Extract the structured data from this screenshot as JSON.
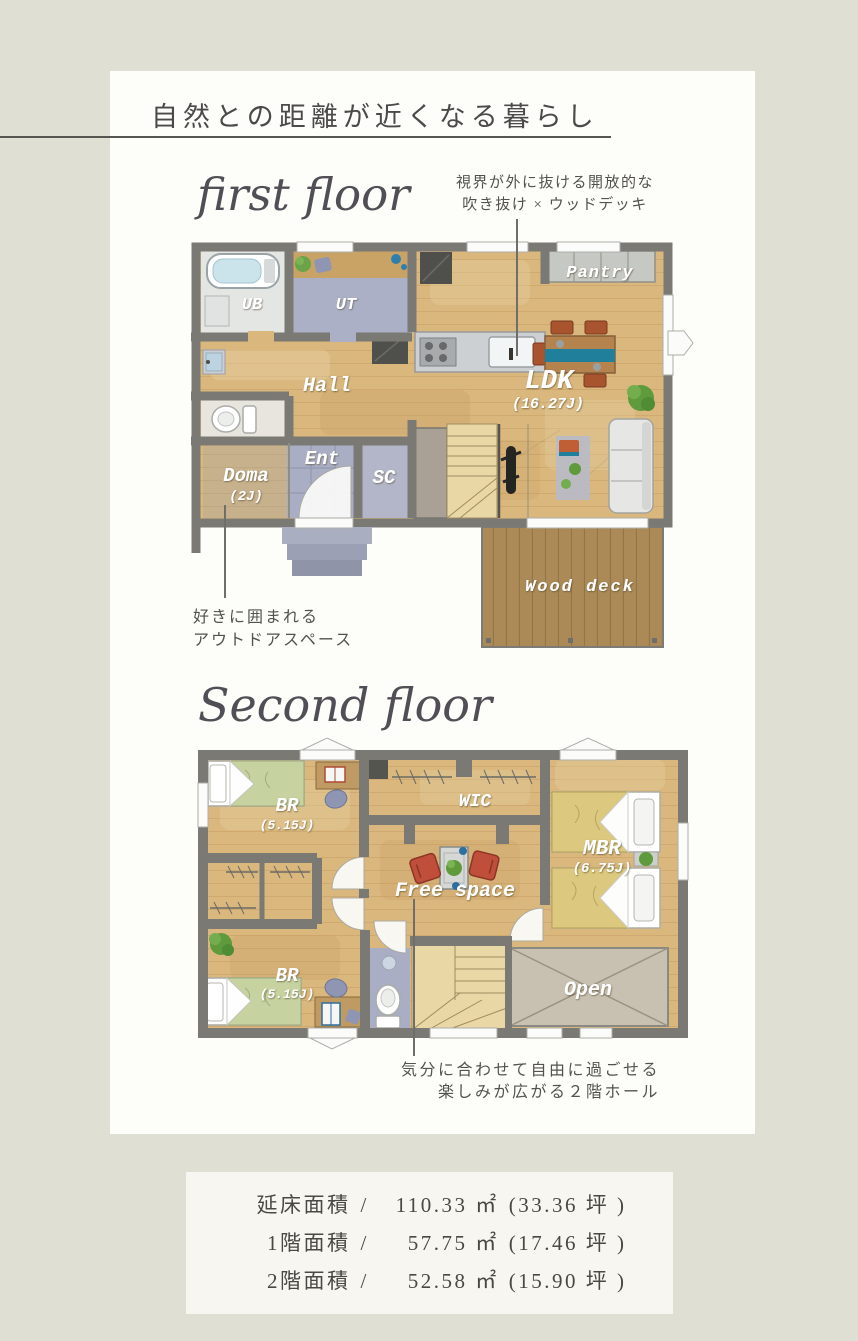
{
  "page": {
    "title": "自然との距離が近くなる暮らし"
  },
  "colors": {
    "page_bg": "#dfdfd4",
    "card_bg": "#fdfdfa",
    "wall_gray": "#7a7974",
    "wood_floor": "#d9b77d",
    "wet_area_blue": "#a9aec5",
    "bath_gray": "#e4e6e4",
    "counter_gray": "#ccd0d2",
    "deck_brown": "#ab8a57",
    "open_beige": "#c8c1b2",
    "table_teal": "#20809b",
    "chair_red": "#bf4f3a",
    "plant_green": "#5f9a3c",
    "bed_green": "#c6d2a0",
    "bed_yellow": "#dcc87e",
    "text_gray": "#4b4a48",
    "label_white": "#ffffff"
  },
  "floor1": {
    "heading": "first floor",
    "callout_top": {
      "line1": "視界が外に抜ける開放的な",
      "line2": "吹き抜け × ウッドデッキ"
    },
    "callout_bottom": {
      "line1": "好きに囲まれる",
      "line2": "アウトドアスペース"
    },
    "rooms": {
      "ub": "UB",
      "ut": "UT",
      "hall": "Hall",
      "ent": "Ent",
      "doma": "Doma",
      "doma_size": "(2J)",
      "sc": "SC",
      "ldk": "LDK",
      "ldk_size": "(16.27J)",
      "pantry": "Pantry",
      "wood_deck": "Wood deck"
    },
    "icons": [
      "bathtub-icon",
      "washbasin-icon",
      "toilet-icon",
      "fridge-icon",
      "kitchen-counter-icon",
      "stove-icon",
      "sink-icon",
      "dining-table-icon",
      "chair-icon",
      "sofa-icon",
      "rug-icon",
      "plant-icon",
      "stairs-icon",
      "floor-lamp-icon",
      "porch-steps-icon",
      "window-icon",
      "door-arc-icon"
    ]
  },
  "floor2": {
    "heading": "Second floor",
    "callout_bottom": {
      "line1": "気分に合わせて自由に過ごせる",
      "line2": "楽しみが広がる２階ホール"
    },
    "rooms": {
      "br1": "BR",
      "br1_size": "(5.15J)",
      "wic": "WIC",
      "mbr": "MBR",
      "mbr_size": "(6.75J)",
      "free_space": "Free space",
      "br2": "BR",
      "br2_size": "(5.15J)",
      "open": "Open"
    },
    "icons": [
      "bed-icon",
      "pillow-icon",
      "desk-icon",
      "book-icon",
      "chair-icon",
      "closet-hanger-icon",
      "low-table-icon",
      "armchair-icon",
      "plant-icon",
      "toilet-icon",
      "stairs-icon",
      "window-icon",
      "door-arc-icon",
      "gable-mark-icon"
    ]
  },
  "stats": {
    "rows": [
      {
        "label": "延床面積",
        "sep": "/",
        "area": "110.33 ㎡",
        "tsubo": "(33.36 坪 )"
      },
      {
        "label": "1階面積",
        "sep": "/",
        "area": "57.75 ㎡",
        "tsubo": "(17.46 坪 )"
      },
      {
        "label": "2階面積",
        "sep": "/",
        "area": "52.58 ㎡",
        "tsubo": "(15.90 坪 )"
      }
    ]
  }
}
